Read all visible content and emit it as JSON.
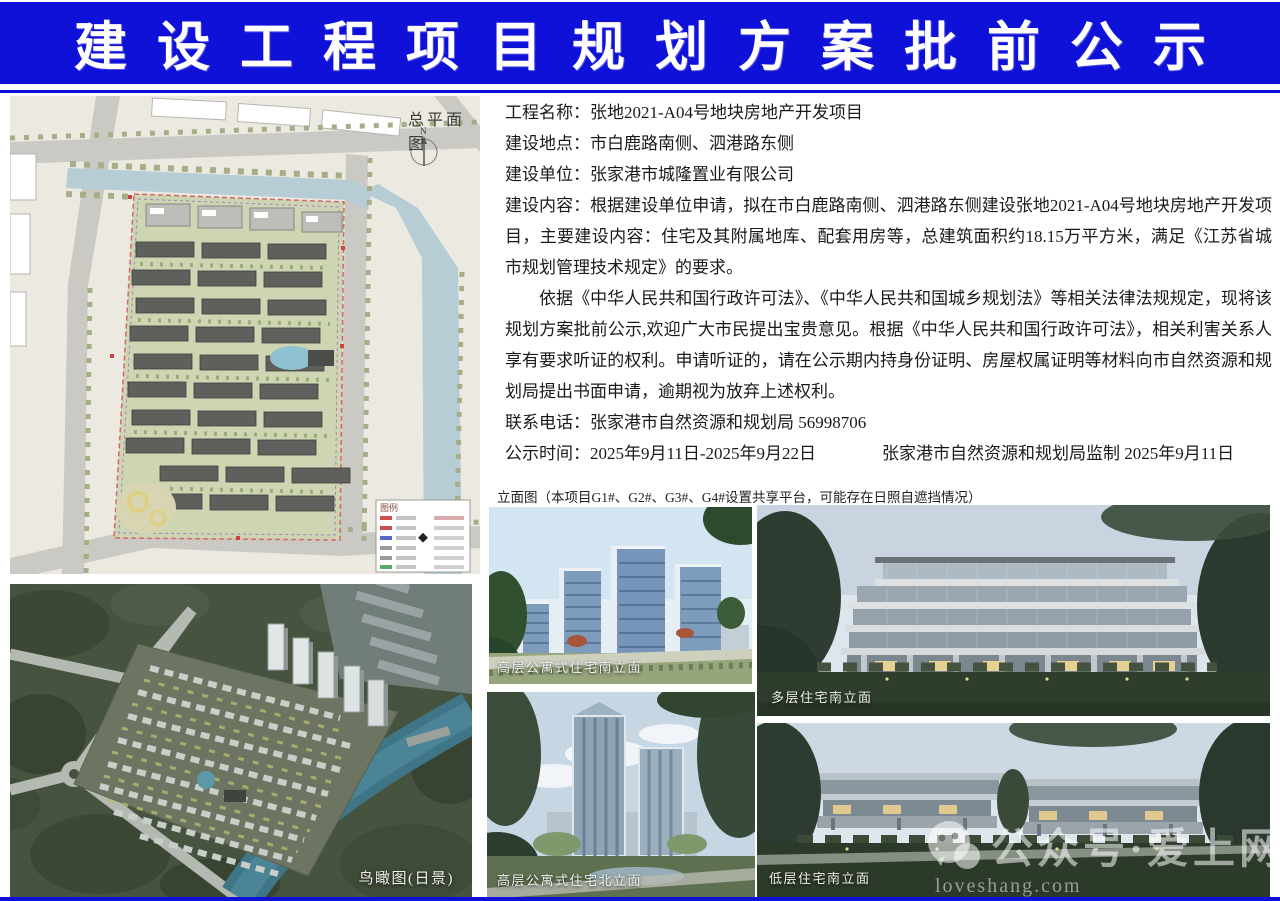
{
  "banner": {
    "title": "建设工程项目规划方案批前公示",
    "bg_color": "#0f11d8"
  },
  "site_plan": {
    "title": "总平面图",
    "north_label": "N",
    "legend_title": "图例"
  },
  "notice": {
    "fields": [
      {
        "label": "工程名称：",
        "value": "张地2021-A04号地块房地产开发项目"
      },
      {
        "label": "建设地点：",
        "value": "市白鹿路南侧、泗港路东侧"
      },
      {
        "label": "建设单位：",
        "value": "张家港市城隆置业有限公司"
      },
      {
        "label": "建设内容：",
        "value": "根据建设单位申请，拟在市白鹿路南侧、泗港路东侧建设张地2021-A04号地块房地产开发项目，主要建设内容：住宅及其附属地库、配套用房等，总建筑面积约18.15万平方米，满足《江苏省城市规划管理技术规定》的要求。"
      }
    ],
    "legal": "依据《中华人民共和国行政许可法》、《中华人民共和国城乡规划法》等相关法律法规规定，现将该规划方案批前公示,欢迎广大市民提出宝贵意见。根据《中华人民共和国行政许可法》，相关利害关系人享有要求听证的权利。申请听证的，请在公示期内持身份证明、房屋权属证明等材料向市自然资源和规划局提出书面申请，逾期视为放弃上述权利。",
    "contact_label": "联系电话：",
    "contact_value": "张家港市自然资源和规划局  56998706",
    "publicity_label": "公示时间：",
    "publicity_value": "2025年9月11日-2025年9月22日",
    "supervision": "张家港市自然资源和规划局监制  2025年9月11日"
  },
  "elevation_note": "立面图（本项目G1#、G2#、G3#、G4#设置共享平台，可能存在日照自遮挡情况）",
  "captions": {
    "birdseye": "鸟瞰图(日景)",
    "highrise_south": "高层公寓式住宅南立面",
    "highrise_north": "高层公寓式住宅北立面",
    "multistory_south": "多层住宅南立面",
    "lowrise_south": "低层住宅南立面"
  },
  "watermark": {
    "account": "公众号·爱上网",
    "domain": "loveshang.com"
  }
}
